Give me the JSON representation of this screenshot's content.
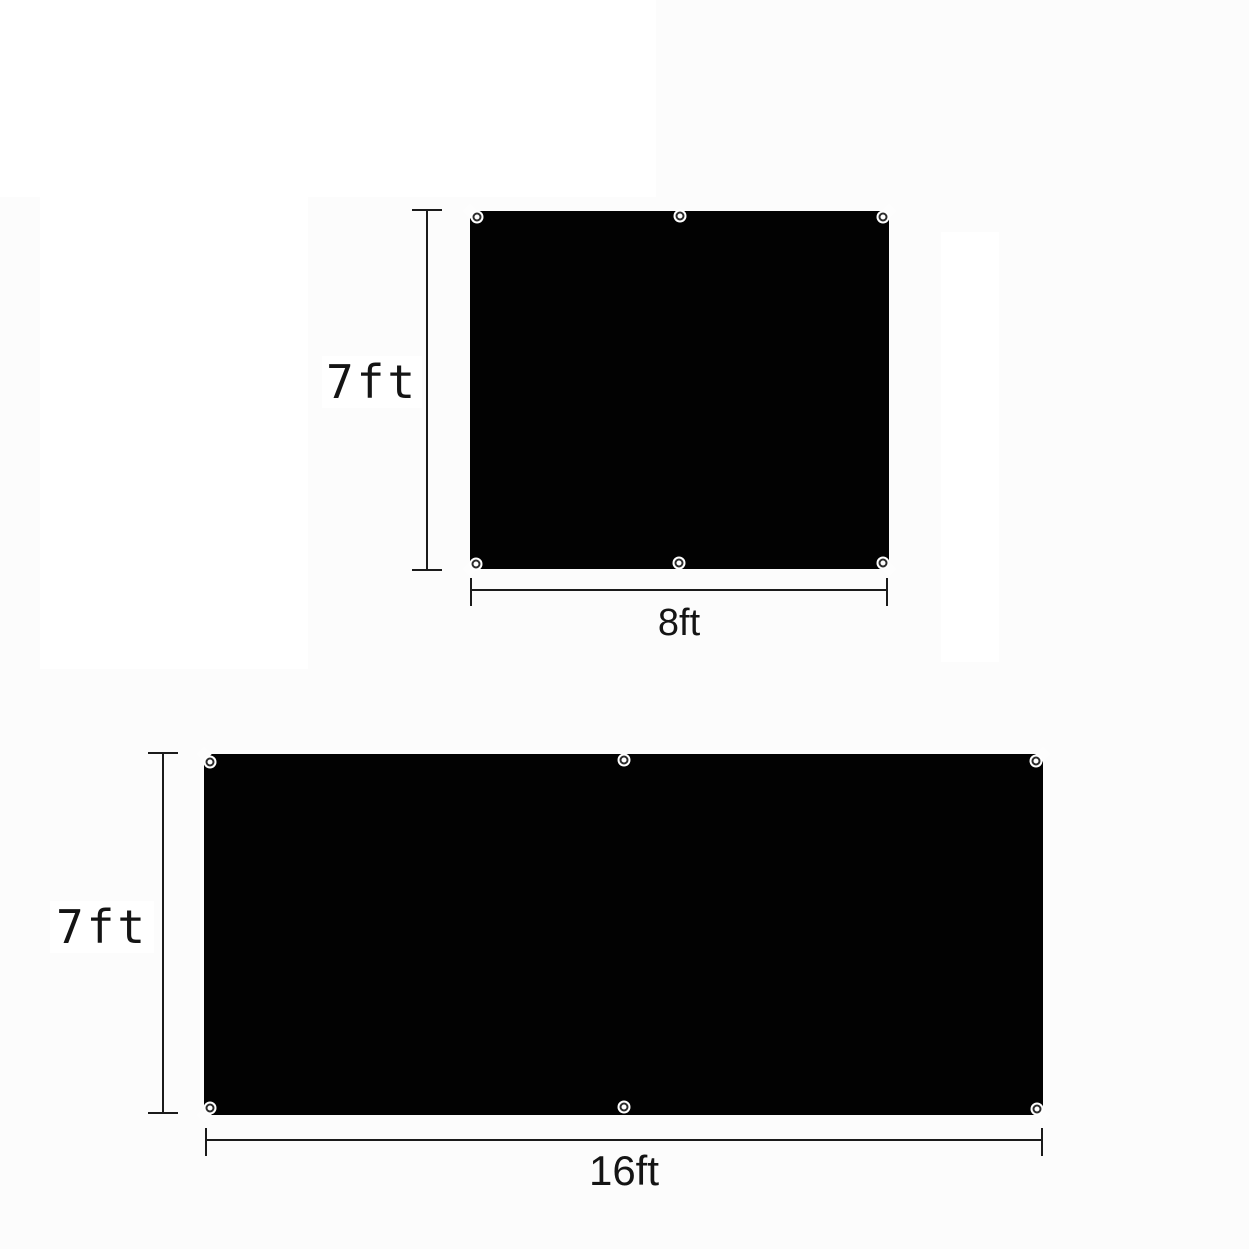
{
  "page": {
    "description": "product dimension diagram of two black grommeted tarp panels",
    "background": "#fcfcfc",
    "panel_color": "#020202",
    "line_color": "#1b1b1b",
    "label_color": "#141414"
  },
  "figures": [
    {
      "name": "panel-8ft-by-7ft",
      "height_label": "7ft",
      "width_label": "8ft",
      "grommet_count": 6
    },
    {
      "name": "panel-16ft-by-7ft",
      "height_label": "7ft",
      "width_label": "16ft",
      "grommet_count": 6
    }
  ]
}
